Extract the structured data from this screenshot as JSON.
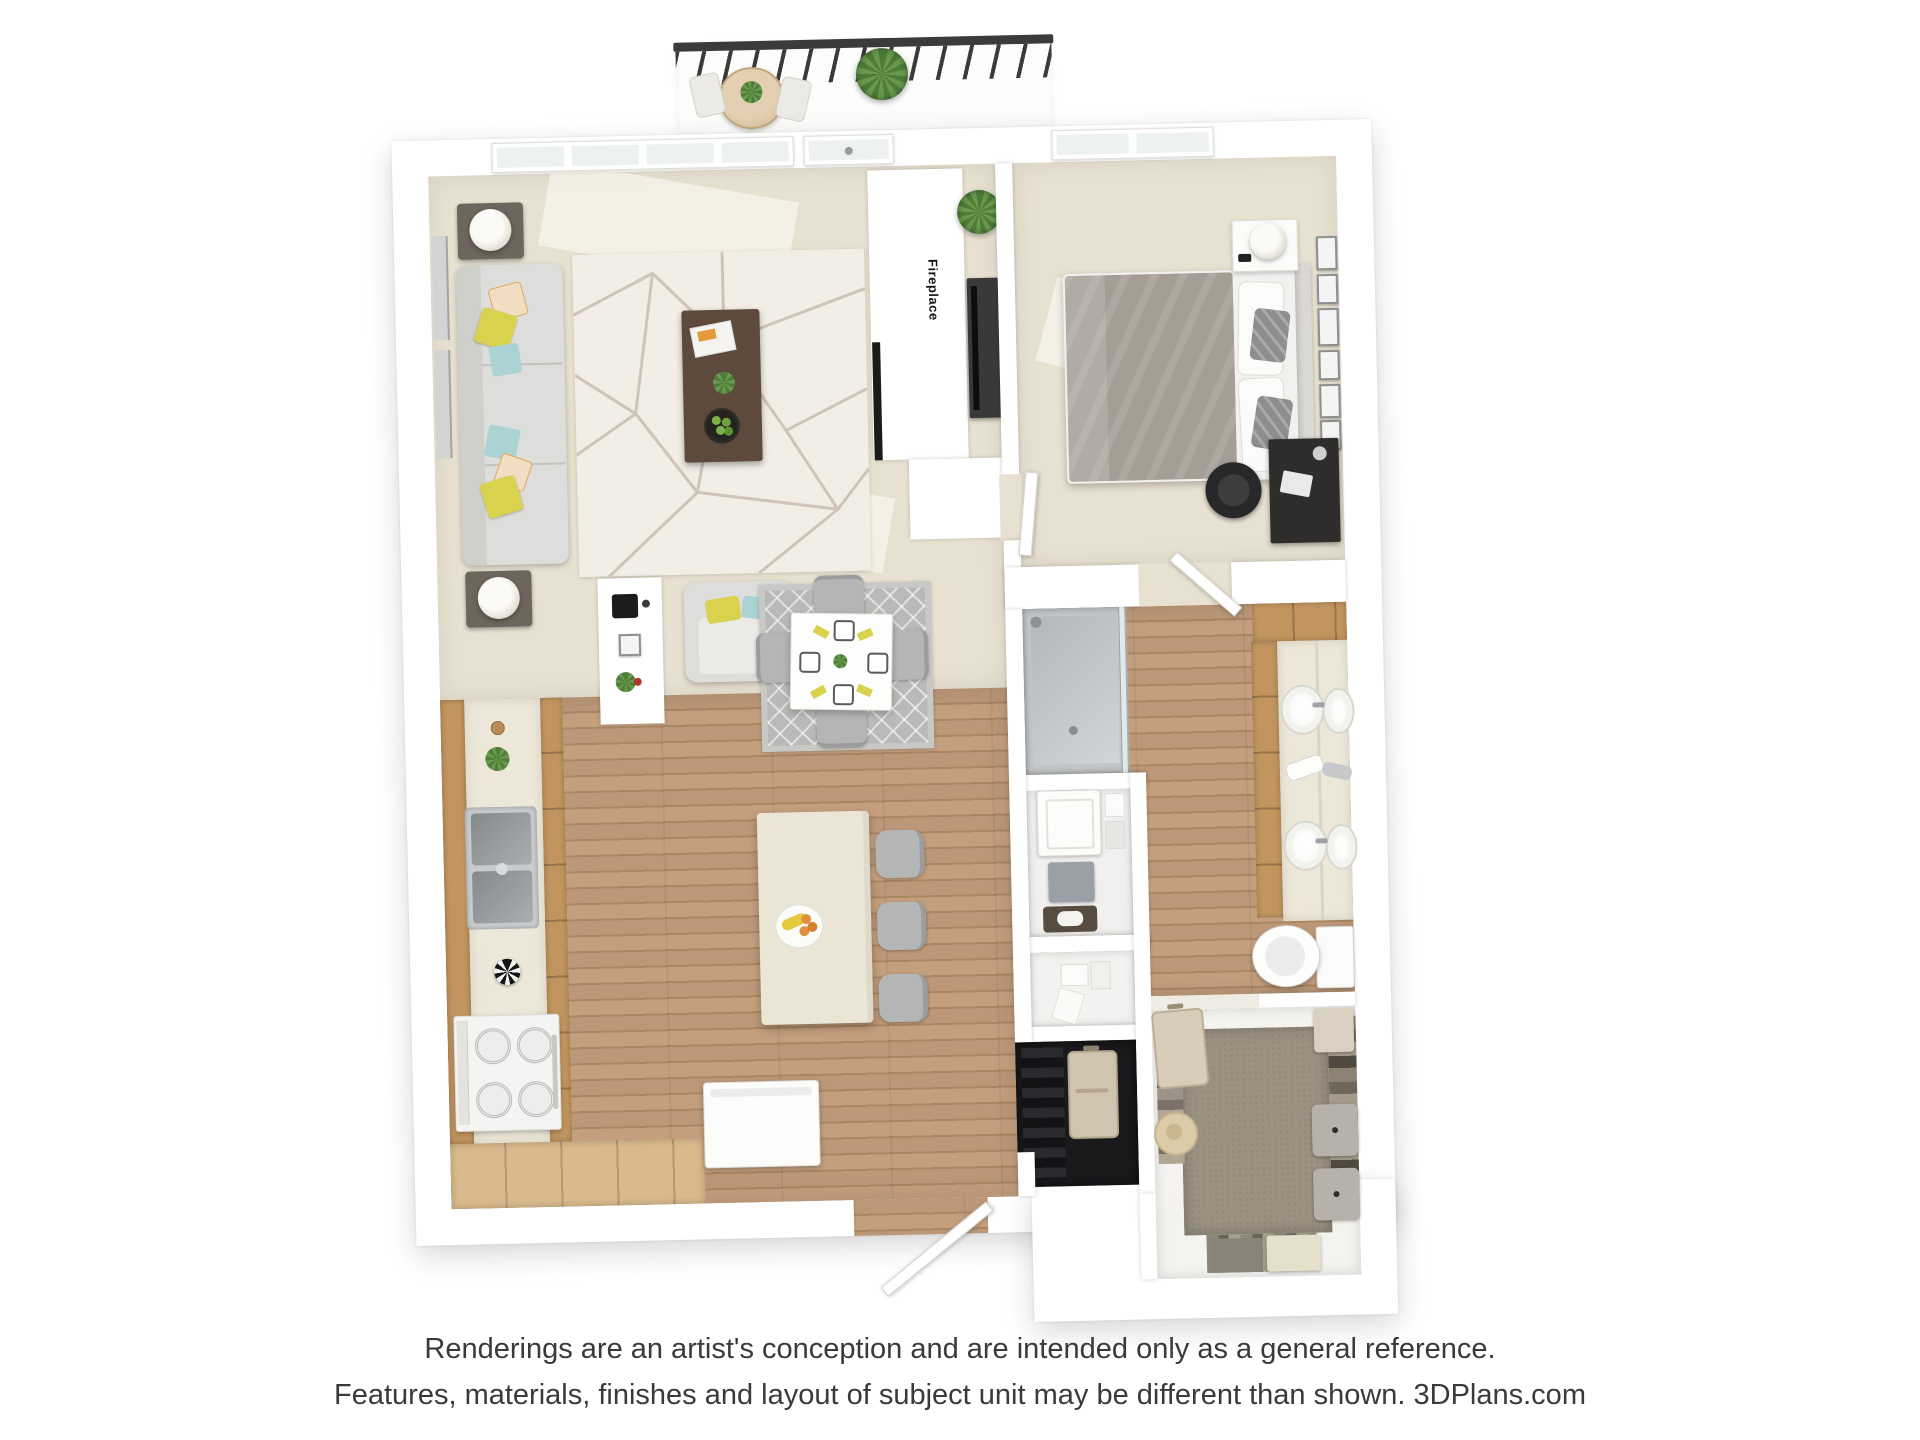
{
  "floorplan": {
    "labels": {
      "fireplace": "Fireplace"
    }
  },
  "disclaimer": {
    "line1": "Renderings are an artist's conception and are intended only as a general reference.",
    "line2": "Features, materials, finishes and layout of subject unit may be different than shown. 3DPlans.com"
  },
  "colors": {
    "wall": "#ffffff",
    "carpet": "#e8e1d1",
    "wood": "#bc9878",
    "wood-dark": "#aa8763",
    "wood-light": "#d9ba8d",
    "cabinet": "#c2955f",
    "counter": "#ece7d8",
    "island": "#eae5d5",
    "rug-living": "#f2ede5",
    "rug-dining": "#b9bab8",
    "sofa": "#dddddb",
    "gray-furniture": "#b4b6b5",
    "duvet": "#a69d95",
    "dark-furniture": "#2e2d2c",
    "railing": "#3b3b3b",
    "plant": "#4e7d3a",
    "plant-light": "#68994c",
    "closet-carpet": "#9a9181",
    "closet-dark": "#1a1a1d",
    "steel": "#b8bcbe",
    "accent-yellow": "#d9d24f",
    "accent-teal": "#abd3d3",
    "text": "#3a3a3a"
  }
}
